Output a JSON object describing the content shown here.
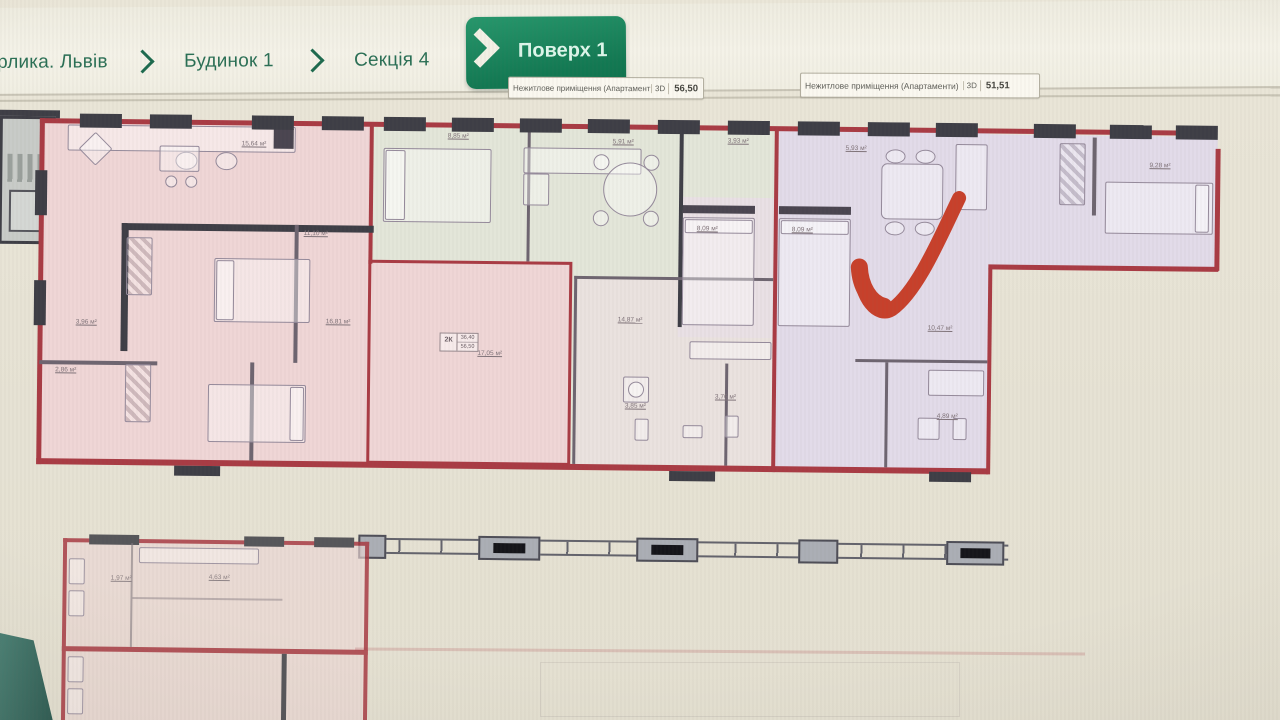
{
  "breadcrumb": {
    "items": [
      {
        "label": "Орлика. Львів",
        "active": false
      },
      {
        "label": "Будинок 1",
        "active": false
      },
      {
        "label": "Секція 4",
        "active": false
      },
      {
        "label": "Поверх 1",
        "active": true
      }
    ]
  },
  "info_badges": [
    {
      "label": "Нежитлове приміщення (Апартаменти)",
      "tag": "3D",
      "value": "56,50"
    },
    {
      "label": "Нежитлове приміщення (Апартаменти)",
      "tag": "3D",
      "value": "51,51"
    }
  ],
  "floorplan": {
    "wall_color": "#a93b44",
    "accent_green": "#17815a",
    "checkmark_color": "#c7402b",
    "apartment_fills": {
      "left": "#efd6d6",
      "middle": "#e3e6d9",
      "right": "#e2dbe9"
    },
    "stamp_lines": [
      "2К",
      "36,40",
      "56,50"
    ],
    "room_area_labels": [
      "15,64 м²",
      "11,10 м²",
      "8,85 м²",
      "5,91 м²",
      "3,93 м²",
      "5,93 м²",
      "9,28 м²",
      "8,09 м²",
      "8,09 м²",
      "16,81 м²",
      "14,87 м²",
      "17,05 м²",
      "10,47 м²",
      "3,85 м²",
      "3,76 м²",
      "4,89 м²",
      "3,96 м²",
      "2,86 м²"
    ],
    "lower_plan_labels": [
      "1,97 м²",
      "4,63 м²"
    ]
  }
}
